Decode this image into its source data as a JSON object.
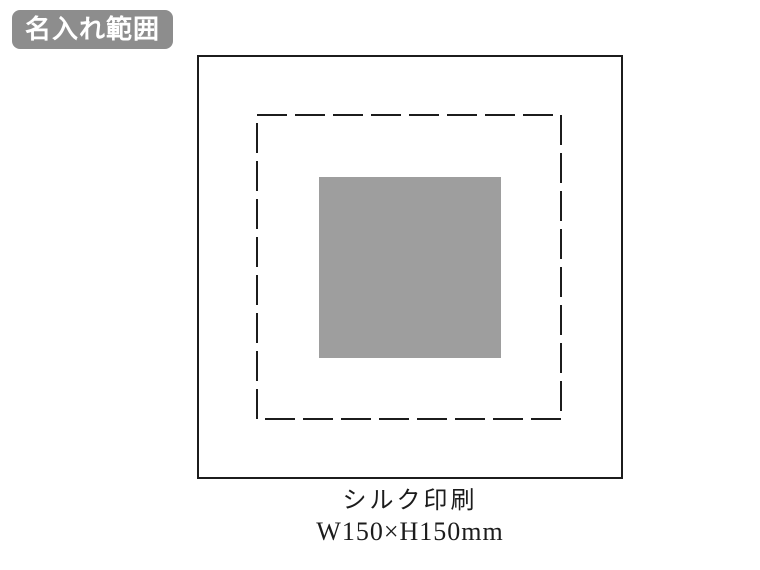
{
  "badge": {
    "label": "名入れ範囲"
  },
  "diagram": {
    "print_method": "シルク印刷",
    "print_size": "W150×H150mm"
  },
  "colors": {
    "badge_bg": "#8d8d8d",
    "badge_text": "#ffffff",
    "outline": "#1c1c1c",
    "print_area_fill": "#9e9e9e",
    "background": "#ffffff"
  }
}
